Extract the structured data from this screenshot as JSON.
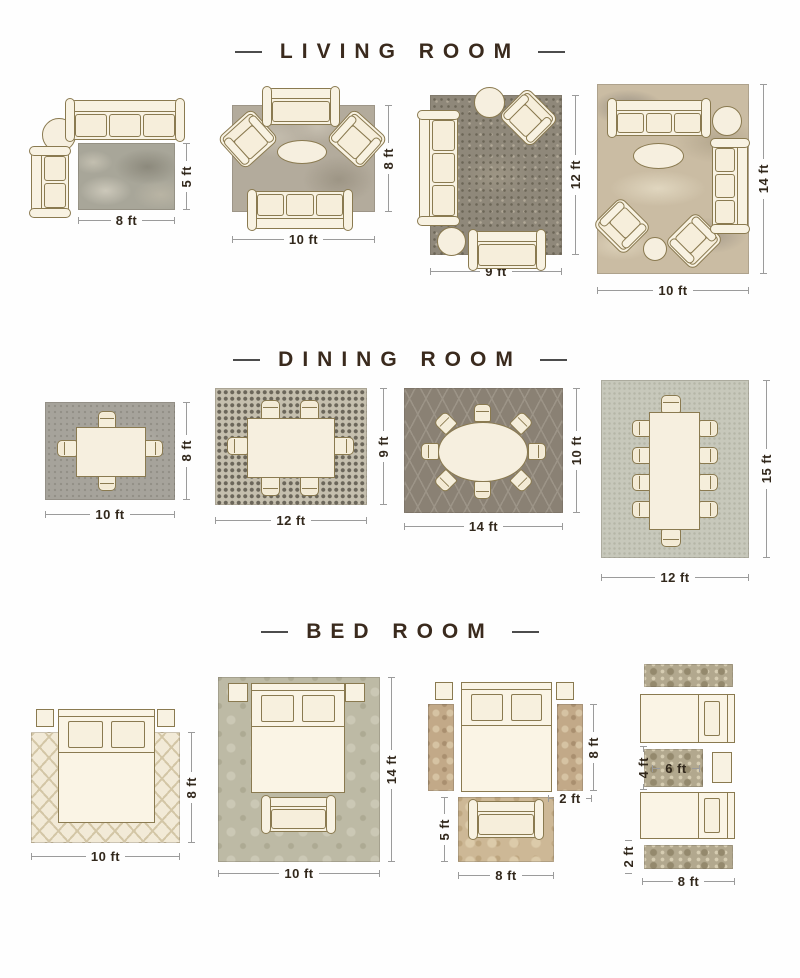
{
  "colors": {
    "title_text": "#3a2a1d",
    "dimension_text": "#32281c",
    "dimension_line": "#9b9b9b",
    "furniture_fill": "#f8f2e2",
    "furniture_outline": "#8a7a50",
    "rugs": {
      "living_8x5": "#a8a699",
      "living_10x8": "#b3ab9c",
      "living_9x12": "#8f887a",
      "living_10x14": "#cabca3",
      "dining_10x8": "#a6a39b",
      "dining_12x9": "#c5bfae",
      "dining_14x10": "#8a8174",
      "dining_12x15": "#c7c8bb",
      "bed_10x8": "#f2ead7",
      "bed_10x14": "#bdbaa5",
      "bed_runner": "#c2a988",
      "bed_foot": "#cdb896",
      "bed_twin": "#b2a88e"
    }
  },
  "sections": {
    "living": {
      "title": "LIVING ROOM",
      "l1": {
        "w": "8 ft",
        "h": "5 ft"
      },
      "l2": {
        "w": "10 ft",
        "h": "8 ft"
      },
      "l3": {
        "w": "9 ft",
        "h": "12 ft"
      },
      "l4": {
        "w": "10 ft",
        "h": "14 ft"
      }
    },
    "dining": {
      "title": "DINING ROOM",
      "d1": {
        "w": "10 ft",
        "h": "8 ft"
      },
      "d2": {
        "w": "12 ft",
        "h": "9 ft"
      },
      "d3": {
        "w": "14 ft",
        "h": "10 ft"
      },
      "d4": {
        "w": "12 ft",
        "h": "15 ft"
      }
    },
    "bedroom": {
      "title": "BED ROOM",
      "b1": {
        "w": "10 ft",
        "h": "8 ft"
      },
      "b2": {
        "w": "10 ft",
        "h": "14 ft"
      },
      "b3": {
        "runner_h": "8 ft",
        "runner_w": "2 ft",
        "foot_h": "5 ft",
        "foot_w": "8 ft"
      },
      "b4": {
        "small_h": "4 ft",
        "small_w": "6 ft",
        "runner_w": "2 ft",
        "runner_l": "8 ft"
      }
    }
  }
}
